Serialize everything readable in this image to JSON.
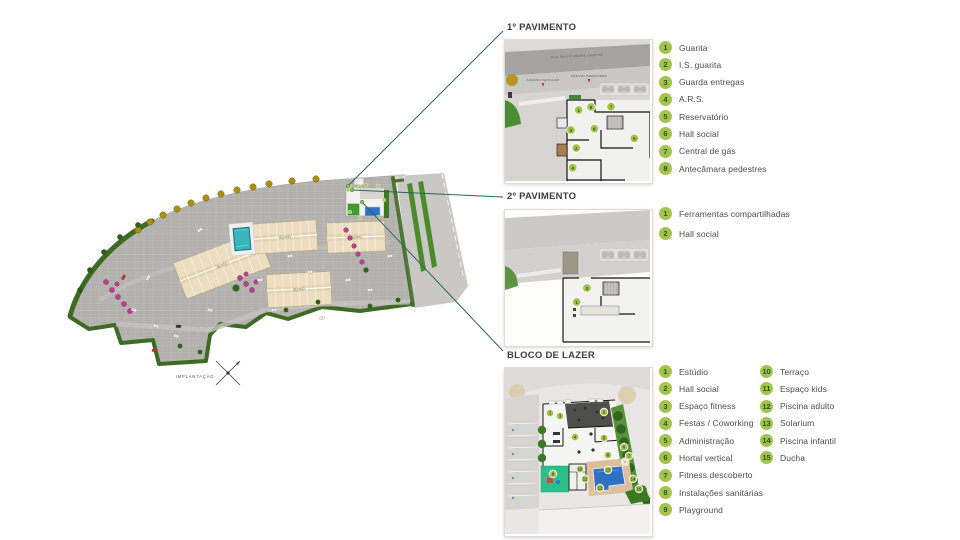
{
  "main_plan": {
    "caption": "IMPLANTAÇÃO",
    "building_label": "BLOCO"
  },
  "sections": {
    "pav1": {
      "title": "1º PAVIMENTO",
      "legend": [
        {
          "num": "1",
          "label": "Guarita"
        },
        {
          "num": "2",
          "label": "I.S. guarita"
        },
        {
          "num": "3",
          "label": "Guarda entregas"
        },
        {
          "num": "4",
          "label": "A.R.S."
        },
        {
          "num": "5",
          "label": "Reservatório"
        },
        {
          "num": "6",
          "label": "Hall social"
        },
        {
          "num": "7",
          "label": "Central de gás"
        },
        {
          "num": "8",
          "label": "Antecâmara pedestres"
        }
      ],
      "plan": {
        "street_name": "RUA PAULO FREIRE CAMPOS",
        "access_vehicular": "ACESSO VEICULAR",
        "access_pedestres": "ACESSO PEDESTRES",
        "markers": [
          {
            "n": "1",
            "x": 73.7,
            "y": 70
          },
          {
            "n": "8",
            "x": 86,
            "y": 67
          },
          {
            "n": "7",
            "x": 106,
            "y": 66.7
          },
          {
            "n": "6",
            "x": 89.3,
            "y": 88.7
          },
          {
            "n": "3",
            "x": 66,
            "y": 90
          },
          {
            "n": "2",
            "x": 71.3,
            "y": 108
          },
          {
            "n": "5",
            "x": 129.3,
            "y": 98.3
          },
          {
            "n": "4",
            "x": 67.7,
            "y": 127.7
          }
        ]
      }
    },
    "pav2": {
      "title": "2º PAVIMENTO",
      "legend": [
        {
          "num": "1",
          "label": "Ferramentas compartilhadas"
        },
        {
          "num": "2",
          "label": "Hall social"
        }
      ],
      "plan": {
        "markers": [
          {
            "n": "2",
            "x": 82,
            "y": 78
          },
          {
            "n": "1",
            "x": 71.7,
            "y": 92
          }
        ]
      }
    },
    "lazer": {
      "title": "BLOCO DE LAZER",
      "legend_col1": [
        {
          "num": "1",
          "label": "Estúdio"
        },
        {
          "num": "2",
          "label": "Hall social"
        },
        {
          "num": "3",
          "label": "Espaço fitness"
        },
        {
          "num": "4",
          "label": "Festas / Coworking"
        },
        {
          "num": "5",
          "label": "Administração"
        },
        {
          "num": "6",
          "label": "Hortal vertical"
        },
        {
          "num": "7",
          "label": "Fitness descoberto"
        },
        {
          "num": "8",
          "label": "Instalações sanitárias"
        },
        {
          "num": "9",
          "label": "Playground"
        }
      ],
      "legend_col2": [
        {
          "num": "10",
          "label": "Terraço"
        },
        {
          "num": "11",
          "label": "Espaço kids"
        },
        {
          "num": "12",
          "label": "Piscina adulto"
        },
        {
          "num": "13",
          "label": "Solarium"
        },
        {
          "num": "14",
          "label": "Piscina infantil"
        },
        {
          "num": "15",
          "label": "Ducha"
        }
      ],
      "plan": {
        "markers": [
          {
            "n": "1",
            "x": 45,
            "y": 45
          },
          {
            "n": "3",
            "x": 55,
            "y": 48
          },
          {
            "n": "2",
            "x": 99,
            "y": 44
          },
          {
            "n": "4",
            "x": 70,
            "y": 69
          },
          {
            "n": "5",
            "x": 99,
            "y": 70
          },
          {
            "n": "6",
            "x": 119,
            "y": 79
          },
          {
            "n": "8",
            "x": 103,
            "y": 87
          },
          {
            "n": "7",
            "x": 124,
            "y": 88
          },
          {
            "n": "9",
            "x": 48,
            "y": 106
          },
          {
            "n": "10",
            "x": 75,
            "y": 101
          },
          {
            "n": "11",
            "x": 80,
            "y": 111
          },
          {
            "n": "13",
            "x": 103,
            "y": 102
          },
          {
            "n": "12",
            "x": 95,
            "y": 120
          },
          {
            "n": "14",
            "x": 128,
            "y": 111
          },
          {
            "n": "15",
            "x": 134,
            "y": 121
          }
        ]
      }
    }
  },
  "colors": {
    "legend_badge": "#a7c24a",
    "legend_badge_text": "#1d5a2f",
    "connector": "#2c6753",
    "title_text": "#3d3d3d",
    "label_text": "#4a4a4a",
    "site_green": "#3f6a23",
    "pool_teal": "#38b6bc",
    "pool_blue": "#2f6fc4",
    "playground_green": "#2abf8c",
    "deck_tan": "#debf9c"
  }
}
